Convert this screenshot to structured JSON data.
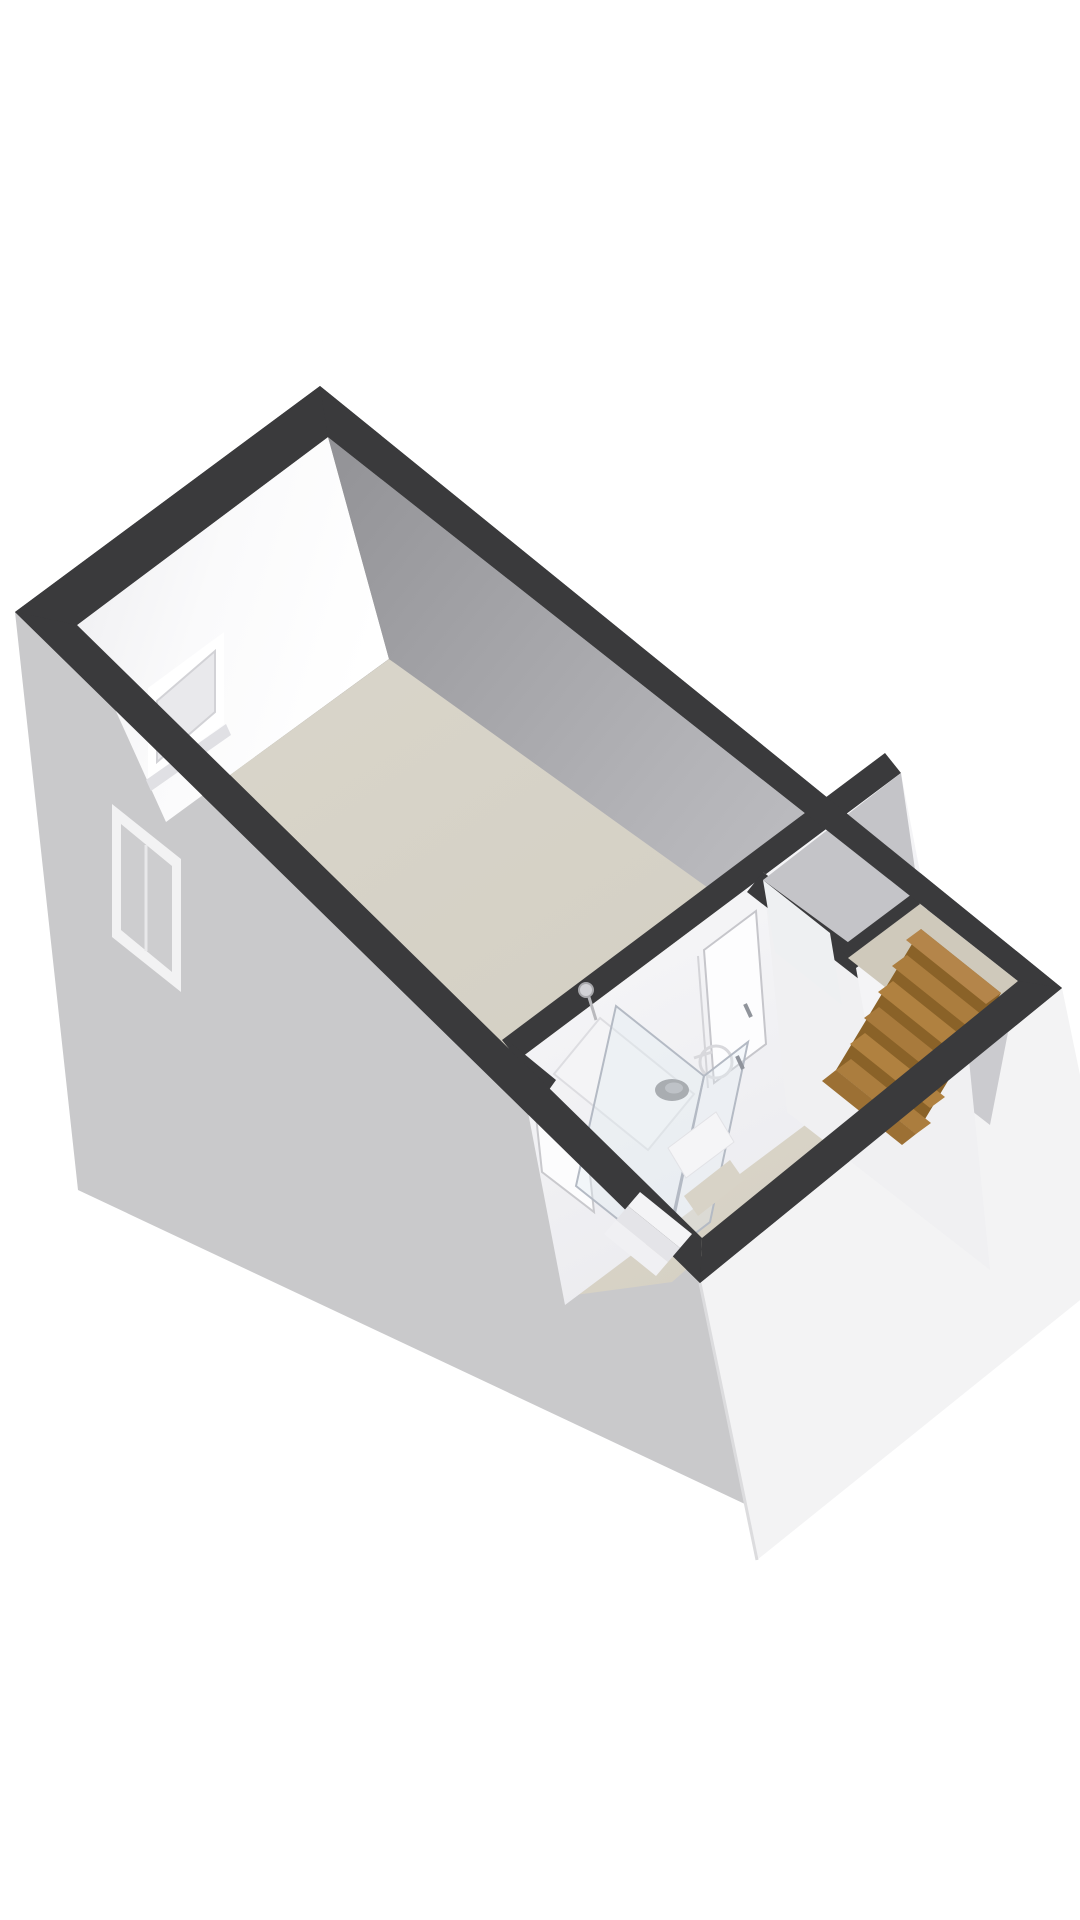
{
  "scene": {
    "type": "3d-floorplan-isometric",
    "floor_label": "",
    "rooms": [
      "main-room",
      "bathroom",
      "hallway",
      "closet",
      "stairwell"
    ],
    "windows_count": 2,
    "doors_count": 3,
    "stairs": {
      "wood_steps_visible": 6,
      "white_steps_visible": 3
    },
    "fixtures": [
      "shower-head",
      "shower-drain",
      "shower-glass-panel",
      "shower-glass-door",
      "mixer-tap-outline"
    ]
  },
  "colors": {
    "background": "#ffffff",
    "wall_top": "#3a3a3c",
    "exterior_left": "#c9c9cb",
    "exterior_right": "#f3f3f4",
    "interior_far_wall": "#b4b4b8",
    "interior_white_wall": "#f6f6f8",
    "floor_main": "#d6d2c7",
    "floor_hall": "#dad5c9",
    "floor_stairwell": "#cfc9bb",
    "wood_light": "#ab7d3e",
    "wood_dark": "#7c5a26",
    "window_frame": "#ffffff",
    "glass": "#e8eef2",
    "drain": "#86868a",
    "white_step": "#f4f4f6"
  }
}
